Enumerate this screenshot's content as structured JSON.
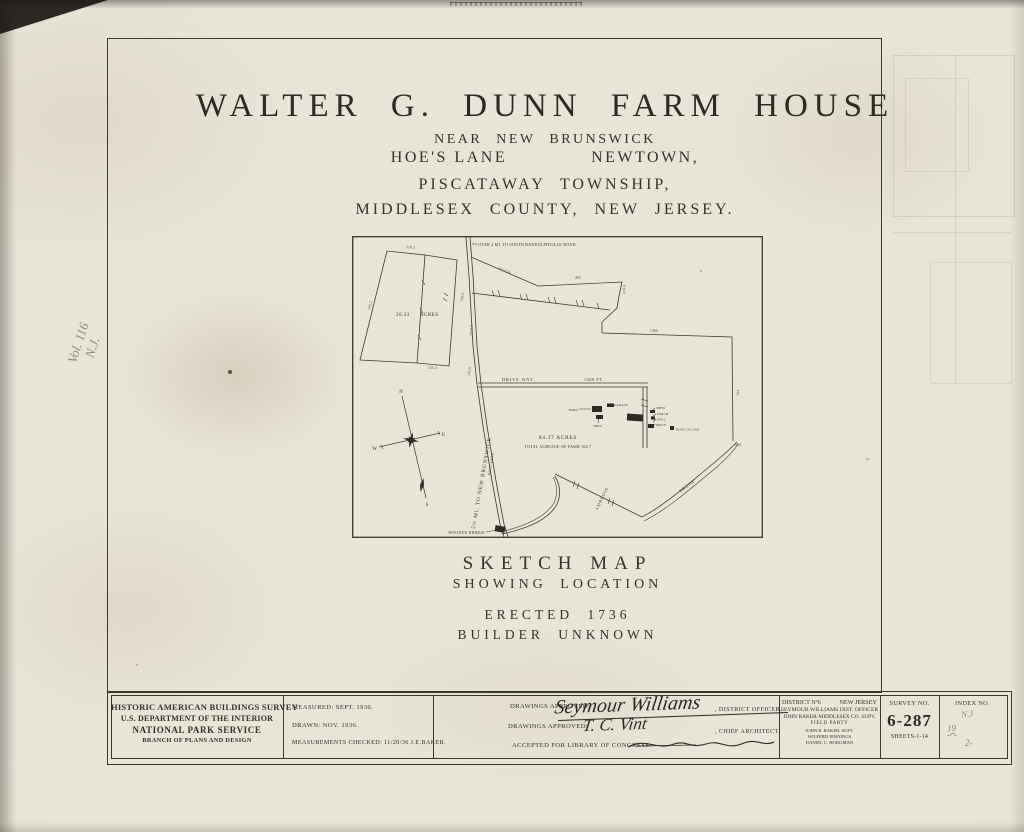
{
  "sheet": {
    "margin_note_line1": "Vol. 116",
    "margin_note_line2": "N.J."
  },
  "title": {
    "name": "WALTER G. DUNN FARM HOUSE",
    "subtitle1": "NEAR NEW BRUNSWICK",
    "subtitle2_left": "HOE'S LANE",
    "subtitle2_right": "NEWTOWN,",
    "subtitle3": "PISCATAWAY TOWNSHIP,",
    "subtitle4": "MIDDLESEX COUNTY, NEW JERSEY."
  },
  "map": {
    "caption_title": "SKETCH MAP",
    "caption_sub": "SHOWING LOCATION",
    "erected": "ERECTED 1736",
    "builder": "BUILDER UNKNOWN",
    "road_note_top": "OVER 4 MI. TO SOUTH RANDOLPHVILLE ROAD",
    "road_name": "5½ MI. TO NEW BRUNSWICK",
    "road_name_small": "HOES LANE",
    "parcel_acres_value": "20.33",
    "parcel_acres_unit": "ACRES",
    "farm_acres": "84.37 ACRES",
    "farm_total": "TOTAL ACREAGE OF FARM 104.7",
    "driveway": "DRIVE WAY",
    "driveway_length": "1300 FT.",
    "wooden_bridge": "WOODEN BRIDGE",
    "brook_name_1": "AMBROSE",
    "brook_name_2": "BROOK",
    "compass": {
      "n": "N",
      "e": "E",
      "s": "S",
      "w": "W"
    },
    "buildings": {
      "barn": "BARN",
      "garage": "GARAGE",
      "shed": "SHED",
      "shed2": "SHED",
      "porch": "PORCH",
      "well": "WELL",
      "privy": "PRIVY",
      "root_cellar": "ROOT CELLAR"
    },
    "dims": {
      "top": "510.2",
      "bottom": "151.3",
      "left": "702.2",
      "road_a": "708.8",
      "road_b": "1033.9",
      "road_c": "145.6",
      "diag": "1013.78",
      "north": "495",
      "east_short": "218.8",
      "east_long": "1366",
      "south_east": "704",
      "corner": "264"
    }
  },
  "titleblock": {
    "agency": [
      "HISTORIC AMERICAN BUILDINGS SURVEY",
      "U.S. DEPARTMENT OF THE INTERIOR",
      "NATIONAL PARK SERVICE",
      "BRANCH OF PLANS AND DESIGN"
    ],
    "measured": "MEASURED: SEPT. 1936.",
    "drawn": "DRAWN: NOV. 1936.",
    "checked": "MEASUREMENTS CHECKED: 11/20/36  J.E.BAKER.",
    "approvals": [
      {
        "label": "DRAWINGS APPROVED:",
        "signature": "Seymour Williams",
        "role": ", DISTRICT OFFICER."
      },
      {
        "label": "DRAWINGS APPROVED:",
        "signature": "T. C. Vint",
        "role": ", CHIEF ARCHITECT."
      }
    ],
    "accepted_label": "ACCEPTED FOR LIBRARY OF CONGRESS:",
    "district": {
      "line1a": "DISTRICT Nº6",
      "line1b": "NEW JERSEY",
      "line2": "SEYMOUR WILLIAMS   DIST. OFFICER",
      "line3": "JOHN BAKER-MIDDLESEX CO. SUPV.",
      "line4": "FIELD PARTY",
      "line5": "JOHN B. BAKER, SUPT.",
      "line6": "WILFERD JENNINGS",
      "line7": "DANIEL C. HODGMAN"
    },
    "survey_label": "SURVEY NO.",
    "survey_no": "6-287",
    "survey_sheets": "SHEETS-1-14",
    "index_label": "INDEX NO.",
    "index_notes": [
      "N.J",
      "19",
      "2-"
    ]
  }
}
